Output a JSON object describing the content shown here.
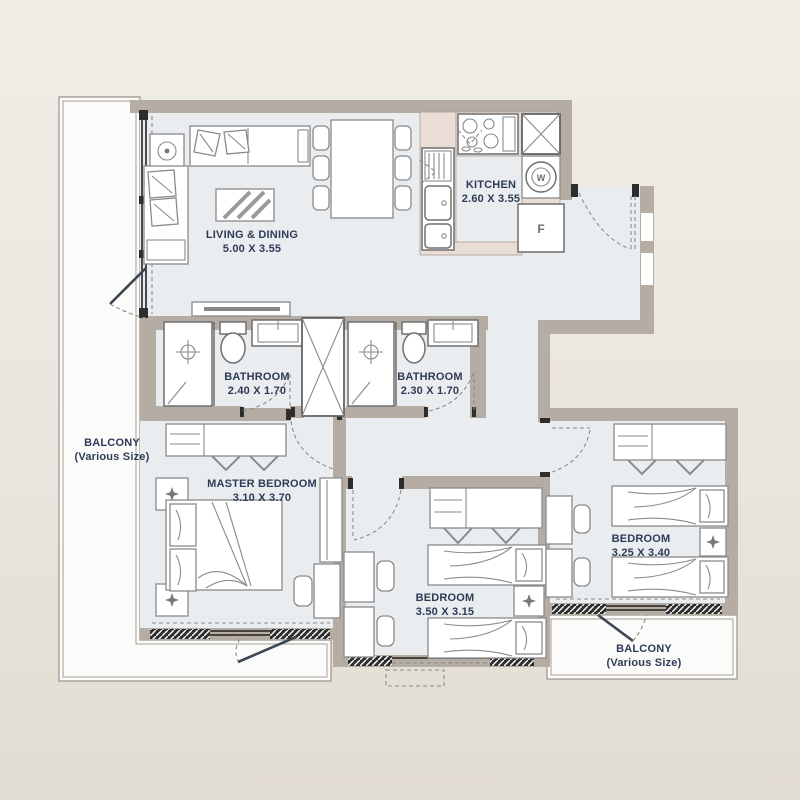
{
  "colors": {
    "wall": "#b5aca4",
    "floor": "#eaedf0",
    "balcony": "#fbfbfa",
    "counter": "#e9ddd5",
    "label": "#2e3b56",
    "bgTop": "#f0ede7",
    "bgMid": "#eae6df",
    "bgBottom": "#e1dcd2"
  },
  "rooms": {
    "living": {
      "name": "LIVING & DINING",
      "dims": "5.00 X 3.55"
    },
    "kitchen": {
      "name": "KITCHEN",
      "dims": "2.60 X 3.55"
    },
    "bath1": {
      "name": "BATHROOM",
      "dims": "2.40 X 1.70"
    },
    "bath2": {
      "name": "BATHROOM",
      "dims": "2.30 X 1.70"
    },
    "master": {
      "name": "MASTER BEDROOM",
      "dims": "3.10 X 3.70"
    },
    "bed2": {
      "name": "BEDROOM",
      "dims": "3.50 X 3.15"
    },
    "bed3": {
      "name": "BEDROOM",
      "dims": "3.25 X 3.40"
    },
    "balconyLeft": {
      "name": "BALCONY",
      "dims": "(Various Size)"
    },
    "balconyRight": {
      "name": "BALCONY",
      "dims": "(Various Size)"
    }
  },
  "markers": {
    "fridge": "F",
    "washer": "W"
  }
}
